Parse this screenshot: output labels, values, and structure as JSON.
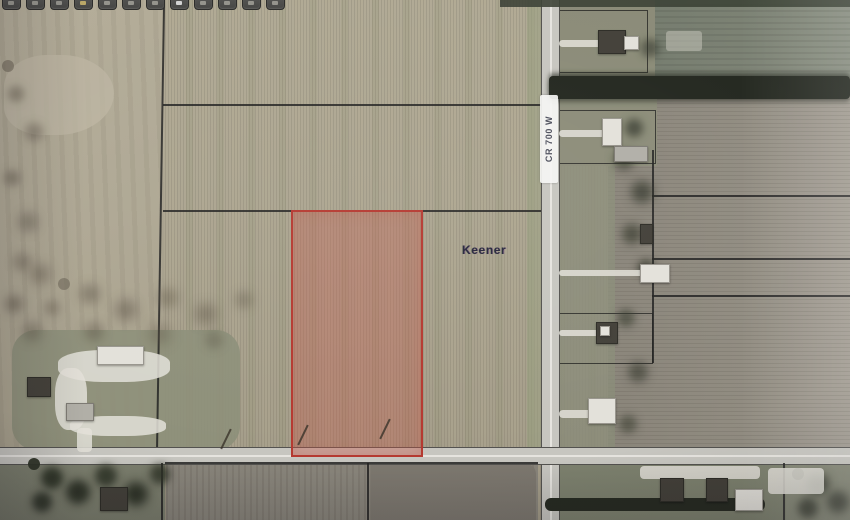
{
  "toolbar": {
    "buttons": [
      {
        "icon": "toolbar-icon"
      },
      {
        "icon": "toolbar-icon"
      },
      {
        "icon": "toolbar-icon"
      },
      {
        "icon": "toolbar-icon"
      },
      {
        "icon": "toolbar-icon"
      },
      {
        "icon": "toolbar-icon"
      },
      {
        "icon": "toolbar-icon"
      },
      {
        "icon": "toolbar-icon"
      },
      {
        "icon": "toolbar-icon"
      },
      {
        "icon": "toolbar-icon"
      },
      {
        "icon": "toolbar-icon"
      },
      {
        "icon": "toolbar-icon"
      }
    ]
  },
  "map": {
    "owner_label": "Keener",
    "road_label": "CR 700 W",
    "colors": {
      "selected_parcel_border": "#c0342a",
      "selected_parcel_fill": "rgba(210,80,64,0.33)",
      "parcel_line": "#20201e",
      "road_surface": "#c9c8c1",
      "road_center_line": "#eceae4"
    }
  }
}
